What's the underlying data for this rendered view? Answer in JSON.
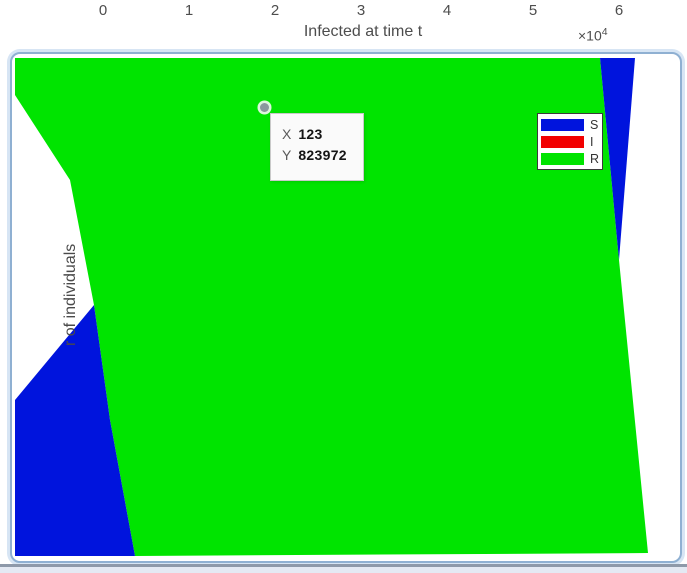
{
  "top_axis": {
    "ticks": [
      "0",
      "1",
      "2",
      "3",
      "4",
      "5",
      "6"
    ],
    "label": "Infected at time t",
    "multiplier_base": "×10",
    "multiplier_exp": "4"
  },
  "y_axis": {
    "visible_label": "r of individuals"
  },
  "datatip": {
    "x_label": "X",
    "x_value": "123",
    "y_label": "Y",
    "y_value": "823972"
  },
  "legend": {
    "items": [
      {
        "label": "S",
        "color": "#0014dd"
      },
      {
        "label": "I",
        "color": "#f20000"
      },
      {
        "label": "R",
        "color": "#00e400"
      }
    ]
  },
  "colors": {
    "recovered_green": "#00e400",
    "susceptible_blue": "#0014dd",
    "plot_background": "#ffffff",
    "panel_border": "#8fb0d2",
    "panel_halo": "#d7e5f4",
    "axis_text": "#4d4d4d",
    "bottom_edge_line": "#8e99a9",
    "bottom_edge_strip": "#e4e9f3"
  },
  "chart_data": {
    "type": "area",
    "title": "",
    "xlabel": "Infected at time t",
    "xlabel_multiplier": "×10^4",
    "x_ticks": [
      0,
      1,
      2,
      3,
      4,
      5,
      6
    ],
    "x_axis_position": "top",
    "ylabel_visible": "r of individuals",
    "series": [
      {
        "name": "S",
        "color": "#0014dd"
      },
      {
        "name": "I",
        "color": "#f20000"
      },
      {
        "name": "R",
        "color": "#00e400"
      }
    ],
    "visible_regions": [
      {
        "series": "R",
        "note": "large green region covering most of zoomed view"
      },
      {
        "series": "S",
        "note": "blue wedge bottom-left and narrow blue wedge at top-right tapering to a point"
      }
    ],
    "datatip_point": {
      "x": 123,
      "y": 823972
    },
    "legend_position": "upper-right",
    "grid": false
  }
}
